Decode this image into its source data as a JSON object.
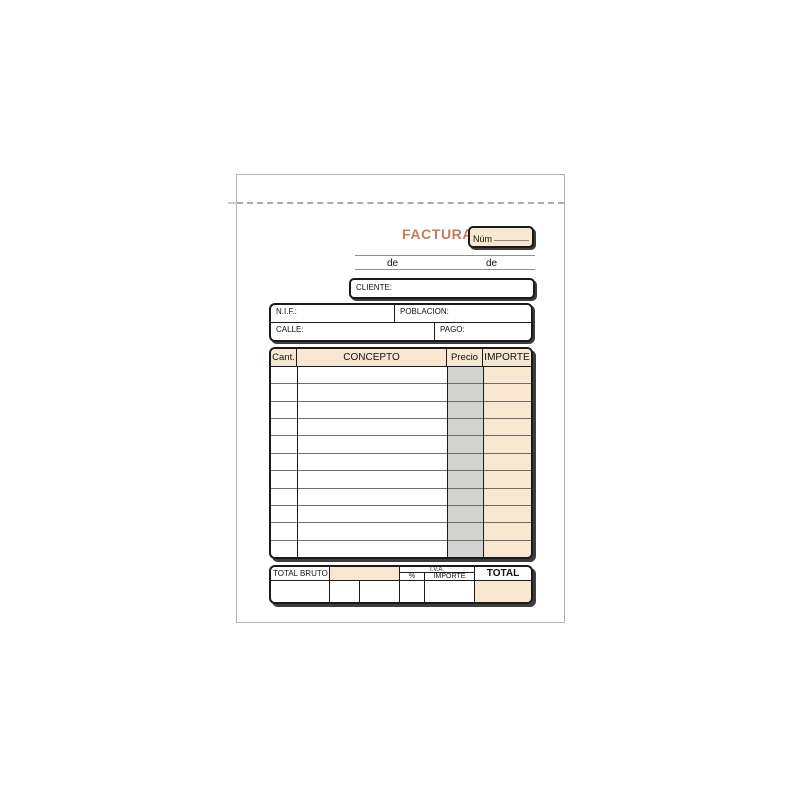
{
  "sheet": {
    "title": "FACTURA",
    "num_box_label": "Núm",
    "date_words": [
      "de",
      "de"
    ],
    "cliente_label": "CLIENTE:",
    "address_fields": {
      "nif": "N.I.F.:",
      "poblacion": "POBLACION:",
      "calle": "CALLE:",
      "pago": "PAGO:"
    }
  },
  "invoice_table": {
    "headers": [
      "Cant.",
      "CONCEPTO",
      "Precio",
      "IMPORTE"
    ],
    "row_count": 11
  },
  "totals": {
    "total_bruto_label": "TOTAL BRUTO",
    "iva_label": "I.V.A.",
    "iva_percent_label": "%",
    "iva_importe_label": "IMPORTE",
    "total_label": "TOTAL"
  },
  "colors": {
    "accent": "#c87a5b",
    "cream": "#f7e7d1",
    "column_gray": "#d3d3d2"
  }
}
